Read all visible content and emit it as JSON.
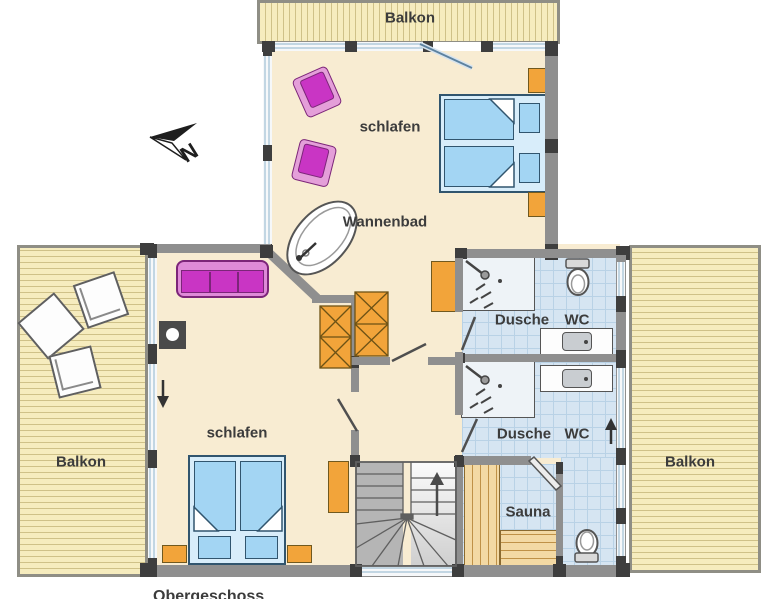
{
  "labels": {
    "balcony_top": "Balkon",
    "balcony_left": "Balkon",
    "balcony_right": "Balkon",
    "bedroom_top": "schlafen",
    "bedroom_bottom": "schlafen",
    "bath_room": "Wannenbad",
    "bath1_shower": "Dusche",
    "bath1_wc": "WC",
    "bath2_shower": "Dusche",
    "bath2_wc": "WC",
    "sauna": "Sauna",
    "floor_name": "Obergeschoss",
    "compass": "N"
  },
  "icons": {
    "north-arrow-icon": "dart arrow pointing north-west with letter N",
    "bathtub-icon": "rotated oval bathtub with tap and drain",
    "shower-icon": "square shower tray with shower head and spray",
    "toilet-icon": "toilet bowl with cistern",
    "sink-icon": "washbasin on counter",
    "stairs-icon": "U-shaped winder staircase with up arrow",
    "stove-icon": "black stove square with white circle",
    "arrow-down-icon": "direction arrow down",
    "arrow-up-icon": "direction arrow up"
  },
  "colors": {
    "wall": "#8f8f8f",
    "wall_node": "#3e3e3e",
    "floor": "#f8ecd2",
    "balcony": "#f6ecbe",
    "tile": "#d6e5f2",
    "bed_blue": "#a3d5f3",
    "furniture_orange": "#f2a43a",
    "furniture_magenta": "#c935c4",
    "window_glass": "#8fb4cc"
  }
}
